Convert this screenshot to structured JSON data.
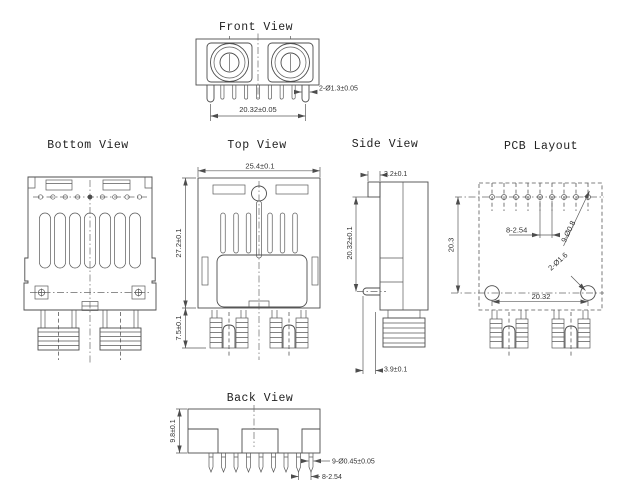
{
  "drawing": {
    "background": "#ffffff",
    "line_color": "#4d4d4d",
    "text_color": "#333333",
    "views": {
      "front": {
        "title": "Front View",
        "dims": {
          "pin_diameter": "2-Ø1.3±0.05",
          "pin_span": "20.32±0.05"
        }
      },
      "bottom": {
        "title": "Bottom View"
      },
      "top": {
        "title": "Top View",
        "dims": {
          "width": "25.4±0.1",
          "height": "27.2±0.1",
          "shank": "7.5±0.1"
        }
      },
      "side": {
        "title": "Side View",
        "dims": {
          "tab_width": "3.2±0.1",
          "pin_height": "20.32±0.1",
          "standoff": "3.9±0.1"
        }
      },
      "pcb": {
        "title": "PCB Layout",
        "dims": {
          "pin_pitch": "8-2.54",
          "pin_holes": "9-Ø0.8",
          "post_holes": "2-Ø1.6",
          "post_span": "20.32",
          "row_gap": "20.3"
        }
      },
      "back": {
        "title": "Back View",
        "dims": {
          "height": "9.8±0.1",
          "pin_diameter": "9-Ø0.45±0.05",
          "pin_pitch": "8-2.54"
        }
      }
    }
  }
}
